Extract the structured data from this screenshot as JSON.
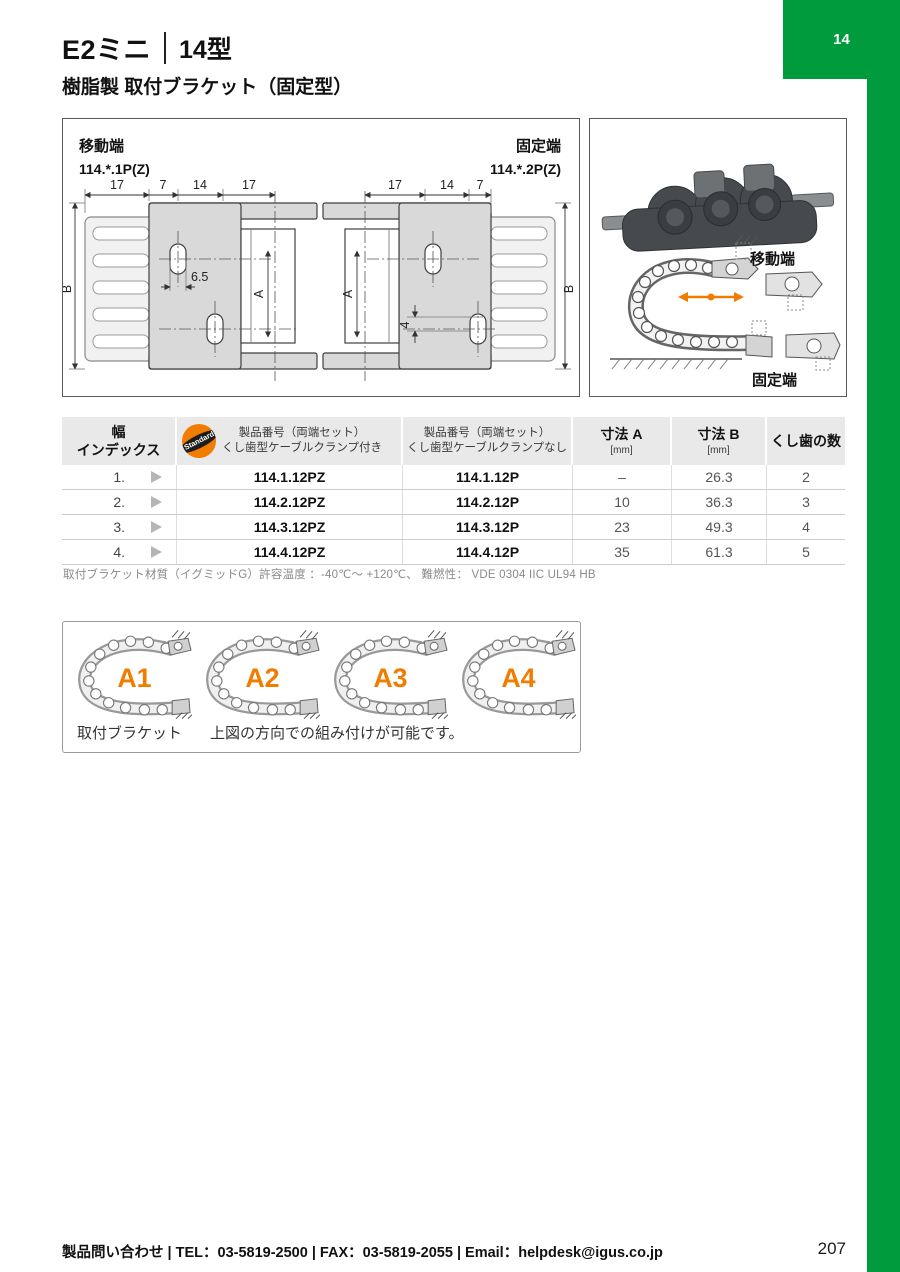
{
  "colors": {
    "green": "#009B3C",
    "orange": "#F07D00",
    "header_gray": "#e9e9e9"
  },
  "page": {
    "chapter_tab": "14",
    "page_number": "207",
    "footer": "製品問い合わせ | TEL：03-5819-2500 | FAX：03-5819-2055 | Email：helpdesk@igus.co.jp"
  },
  "header": {
    "title_main": "E2ミニ",
    "title_model": "14型",
    "subtitle": "樹脂製 取付ブラケット（固定型）"
  },
  "drawing": {
    "moving_end_label": "移動端",
    "moving_end_part": "114.*.1P(Z)",
    "fixed_end_label": "固定端",
    "fixed_end_part": "114.*.2P(Z)",
    "dims_left": [
      "17",
      "7",
      "14",
      "17"
    ],
    "dims_right": [
      "17",
      "14",
      "7"
    ],
    "dim_b_left": "B",
    "dim_b_right": "B",
    "dim_a_left": "A",
    "dim_a_right": "A",
    "dim_hole": "6.5",
    "dim_offset": "4"
  },
  "illustration": {
    "moving_end": "移動端",
    "fixed_end": "固定端"
  },
  "table": {
    "headers": {
      "col1_line1": "幅",
      "col1_line2": "インデックス",
      "col2_line1": "製品番号（両端セット）",
      "col2_line2": "くし歯型ケーブルクランプ付き",
      "col3_line1": "製品番号（両端セット）",
      "col3_line2": "くし歯型ケーブルクランプなし",
      "col4_line1": "寸法 A",
      "col4_line2": "[mm]",
      "col5_line1": "寸法 B",
      "col5_line2": "[mm]",
      "col6": "くし歯の数",
      "badge": "Standard"
    },
    "rows": [
      {
        "index": "1.",
        "pz": "114.1.12PZ",
        "p": "114.1.12P",
        "a": "–",
        "b": "26.3",
        "teeth": "2"
      },
      {
        "index": "2.",
        "pz": "114.2.12PZ",
        "p": "114.2.12P",
        "a": "10",
        "b": "36.3",
        "teeth": "3"
      },
      {
        "index": "3.",
        "pz": "114.3.12PZ",
        "p": "114.3.12P",
        "a": "23",
        "b": "49.3",
        "teeth": "4"
      },
      {
        "index": "4.",
        "pz": "114.4.12PZ",
        "p": "114.4.12P",
        "a": "35",
        "b": "61.3",
        "teeth": "5"
      }
    ],
    "note": "取付ブラケット材質（イグミッドG）許容温度 ：-40℃～ +120℃、 難燃性： VDE 0304 IIC UL94 HB"
  },
  "orientation": {
    "labels": [
      "A1",
      "A2",
      "A3",
      "A4"
    ],
    "caption_left": "取付ブラケット",
    "caption_right": "上図の方向での組み付けが可能です。"
  }
}
